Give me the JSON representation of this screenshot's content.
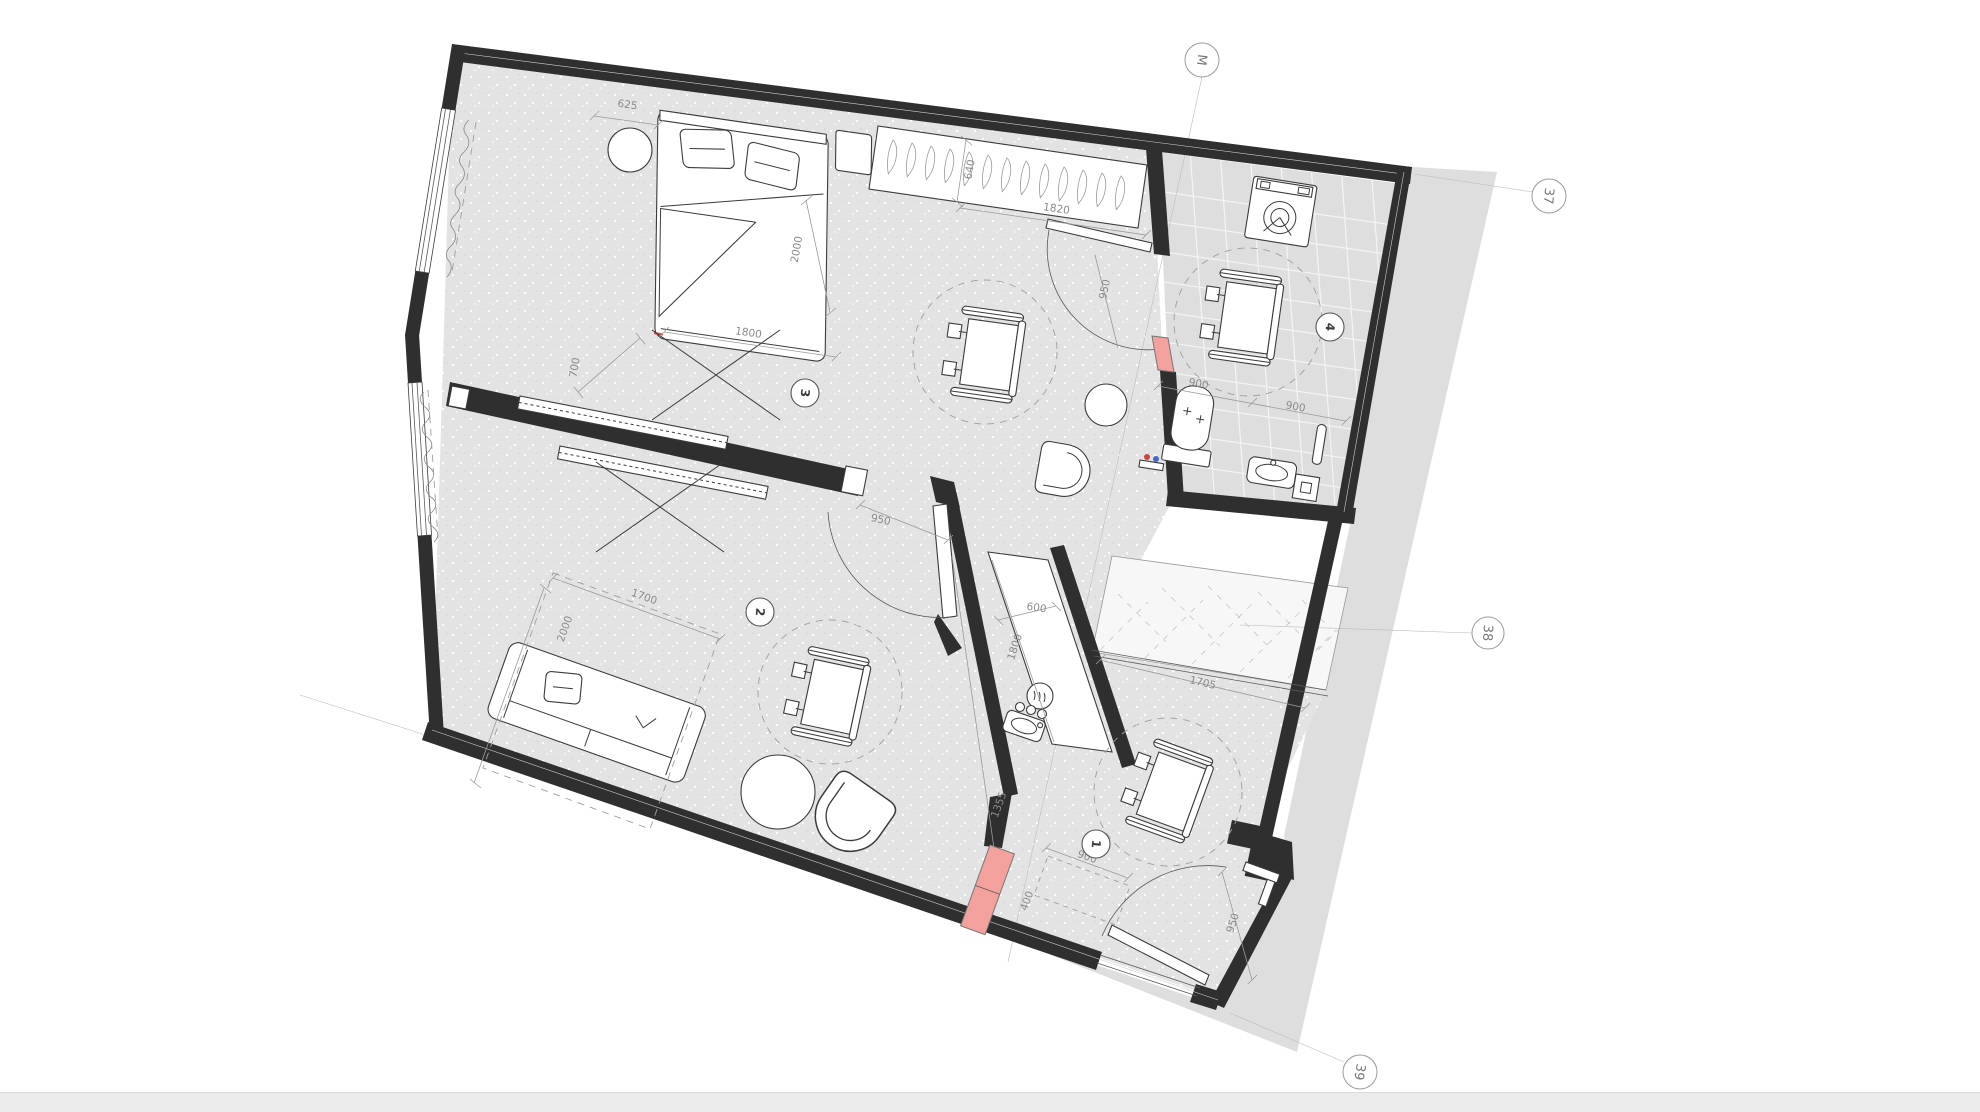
{
  "axis_markers": {
    "m": "M",
    "n37": "37",
    "n38": "38",
    "n39": "39"
  },
  "room_labels": {
    "r1": "1",
    "r2": "2",
    "r3": "3",
    "r4": "4"
  },
  "dimensions": {
    "bed_offset": "625",
    "bed_width": "1800",
    "bed_length": "2000",
    "bed_gap": "700",
    "wardrobe_depth": "640",
    "wardrobe_width": "1820",
    "bath_door": "950",
    "bath_a": "900",
    "bath_b": "900",
    "sofa_zone_w": "1700",
    "sofa_zone_l": "2000",
    "hall_door": "950",
    "kitchen_depth": "600",
    "kitchen_len": "1800",
    "balcony": "1705",
    "entry_wall": "1355",
    "entry_clear_w": "900",
    "entry_clear_d": "400",
    "entry_door": "950"
  },
  "colors": {
    "wall": "#2f2f2f",
    "floor": "#e3e3e3",
    "shadow": "#dedede",
    "highlight": "#f2a19d",
    "dim_text": "#8a8a8a"
  }
}
